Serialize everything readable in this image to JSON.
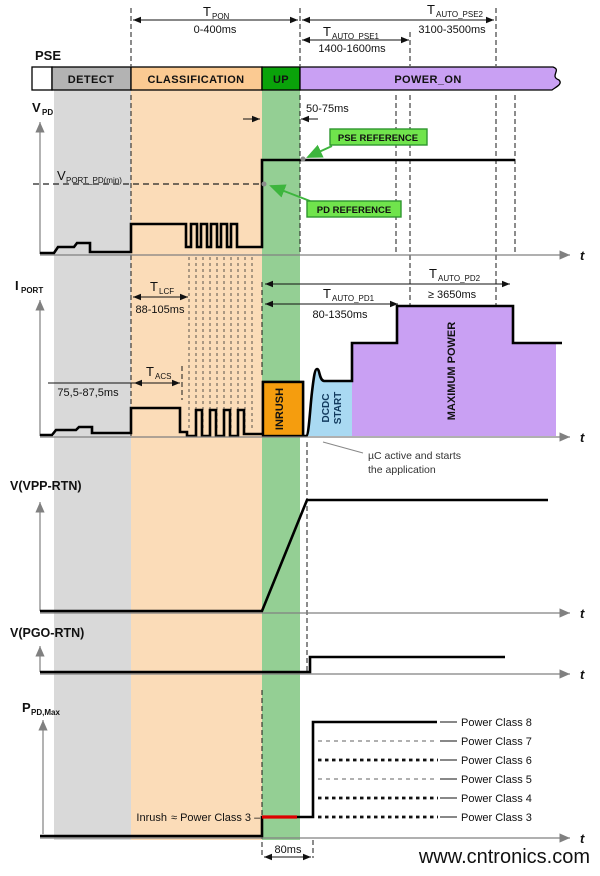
{
  "colors": {
    "band_gray": "#d9d9d9",
    "band_orange": "#fbdcb8",
    "band_green": "#94cf94",
    "bar_detect": "#b3b3b3",
    "bar_classification": "#fbca92",
    "bar_up": "#0aa30a",
    "bar_power_on": "#c9a0f3",
    "inrush_fill": "#f59d0e",
    "dcdc_fill": "#a9d9f2",
    "max_power_fill": "#c9a0f3",
    "ref_box_fill": "#70e44c",
    "ref_box_border": "#2f962f",
    "ref_arrow": "#3db53d",
    "inrush_red": "#dd0000",
    "watermark": "#b9e7b3",
    "axis_gray": "#808080"
  },
  "top": {
    "pse_label": "PSE",
    "t_pon": {
      "main": "T",
      "sub": "PON",
      "value": "0-400ms"
    },
    "t_auto_pse1": {
      "main": "T",
      "sub": "AUTO_PSE1",
      "value": "1400-1600ms"
    },
    "t_auto_pse2": {
      "main": "T",
      "sub": "AUTO_PSE2",
      "value": "3100-3500ms"
    }
  },
  "bar": {
    "detect": "DETECT",
    "classification": "CLASSIFICATION",
    "up": "UP",
    "power_on": "POWER_ON"
  },
  "axes": {
    "t": "t"
  },
  "vpd": {
    "axis": {
      "main": "V",
      "sub": "PD"
    },
    "vport": {
      "main": "V",
      "sub": "PORT_PD(min)"
    },
    "t50": "50-75ms",
    "pse_reference": "PSE REFERENCE",
    "pd_reference": "PD REFERENCE"
  },
  "iport": {
    "axis": {
      "main": "I",
      "sub": "PORT"
    },
    "t_lcf": {
      "main": "T",
      "sub": "LCF",
      "value": "88-105ms"
    },
    "t_acs": {
      "main": "T",
      "sub": "ACS",
      "value": "75,5-87,5ms"
    },
    "t_auto_pd1": {
      "main": "T",
      "sub": "AUTO_PD1",
      "value": "80-1350ms"
    },
    "t_auto_pd2": {
      "main": "T",
      "sub": "AUTO_PD2",
      "value": "≥ 3650ms"
    },
    "inrush": "INRUSH",
    "dcdc_line1": "DCDC",
    "dcdc_line2": "START",
    "max_power": "MAXIMUM POWER",
    "uc_note_line1": "µC active and starts",
    "uc_note_line2": "the application"
  },
  "vvpp": {
    "label": "V(VPP-RTN)"
  },
  "vpgo": {
    "label": "V(PGO-RTN)"
  },
  "ppd": {
    "axis": {
      "main": "P",
      "sub": "PD,Max"
    },
    "inrush_red_text": "Inrush",
    "inrush_black_text": "≈ Power Class 3 –",
    "t80": "80ms",
    "classes": [
      "Power Class 8",
      "Power Class 7",
      "Power Class 6",
      "Power Class 5",
      "Power Class 4",
      "Power Class 3"
    ]
  },
  "watermark": "www.cntronics.com"
}
